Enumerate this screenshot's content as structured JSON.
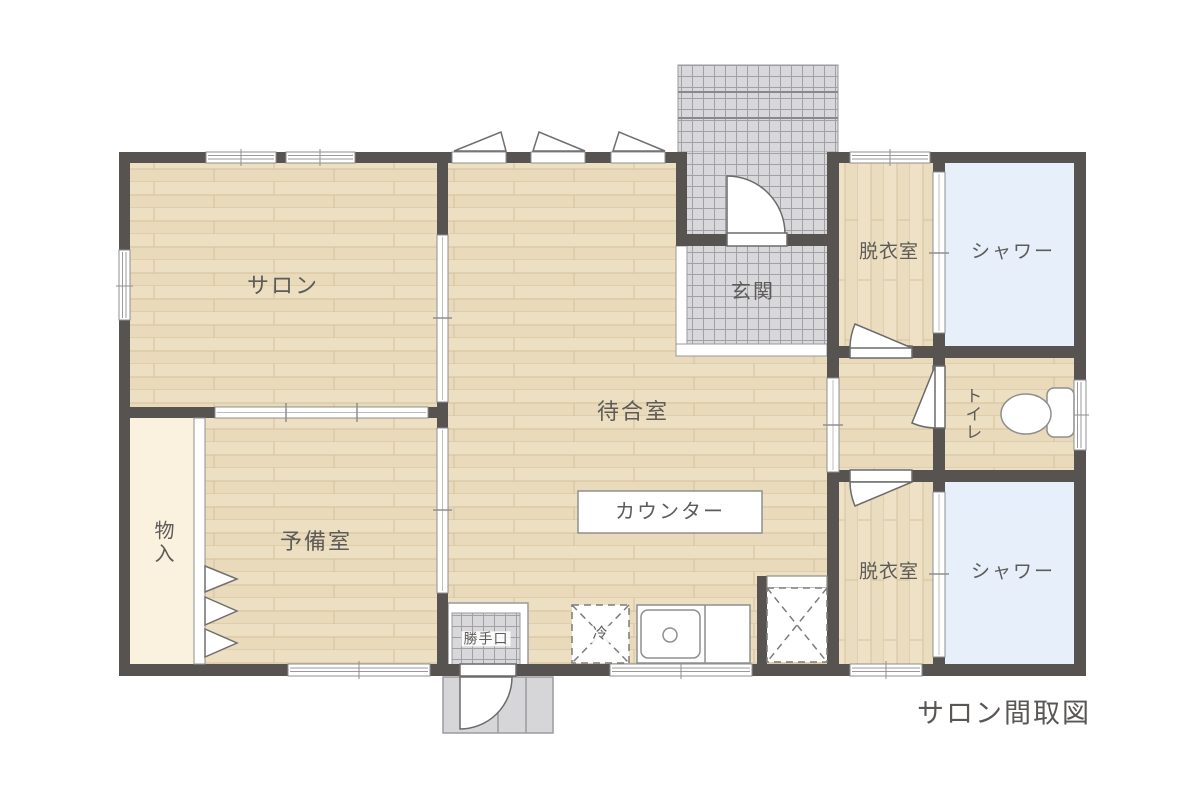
{
  "title": "サロン間取図",
  "rooms": {
    "salon": "サロン",
    "waiting_room": "待合室",
    "spare_room": "予備室",
    "entrance": "玄関",
    "storage": "物入",
    "dressing_room_top": "脱衣室",
    "shower_top": "シャワー",
    "toilet": "トイレ",
    "dressing_room_bottom": "脱衣室",
    "shower_bottom": "シャワー"
  },
  "fixtures": {
    "counter": "カウンター",
    "back_door": "勝手口",
    "refrigerator": "冷"
  },
  "colors": {
    "wall": "#575350",
    "wood_floor": "#e9dcbc",
    "tile_floor": "#d8d8db",
    "shower_floor": "#e6effa",
    "storage_floor": "#faf2df",
    "label_text": "#5e5b58"
  }
}
